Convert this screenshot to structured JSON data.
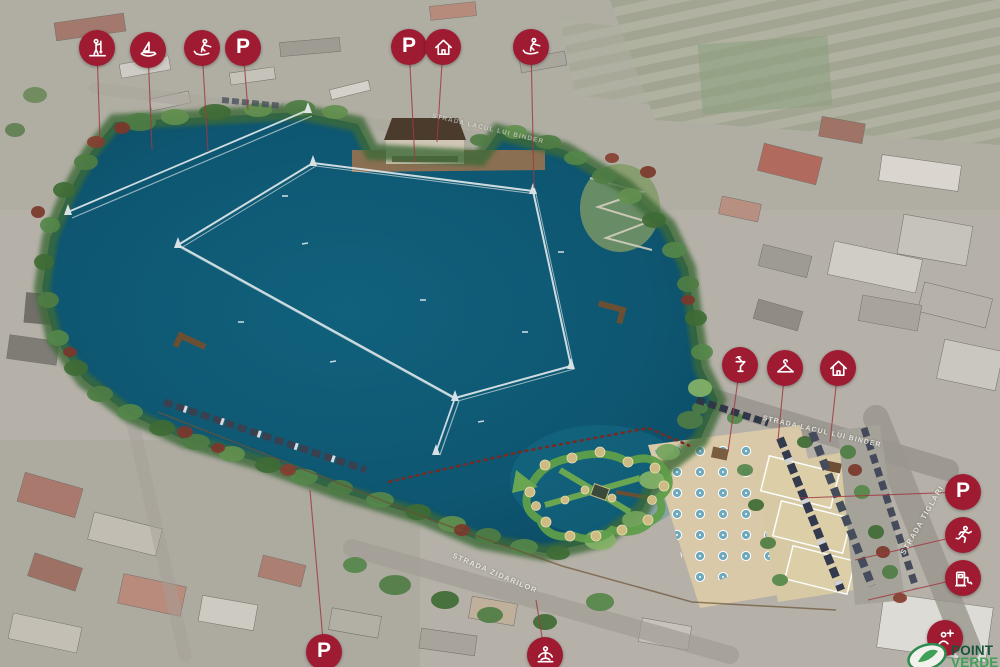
{
  "map": {
    "streets": [
      {
        "id": "binder-top",
        "name": "STRADA LACUL LUI BINDER"
      },
      {
        "id": "binder-mid",
        "name": "STRADA LACUL LUI BINDER"
      },
      {
        "id": "zidarilor",
        "name": "STRADA ZIDARILOR"
      },
      {
        "id": "tiglari",
        "name": "STRADA TIGLARI"
      }
    ],
    "logo": {
      "line1": "POINT",
      "line2": "VERDE"
    },
    "glyphs": {
      "parking": "P"
    },
    "colors": {
      "marker": "#9e1b32",
      "leader": "#a23a42",
      "lake": "#0e5a74",
      "logo_green_dark": "#17553a",
      "logo_green_light": "#3fa057"
    },
    "markers": [
      {
        "type": "sup",
        "x": 97,
        "y": 48,
        "tx": 100,
        "ty": 140
      },
      {
        "type": "sailing",
        "x": 148,
        "y": 50,
        "tx": 152,
        "ty": 150
      },
      {
        "type": "waterski",
        "x": 202,
        "y": 48,
        "tx": 208,
        "ty": 152
      },
      {
        "type": "parking",
        "x": 243,
        "y": 48,
        "tx": 248,
        "ty": 110
      },
      {
        "type": "parking",
        "x": 409,
        "y": 47,
        "tx": 415,
        "ty": 162
      },
      {
        "type": "house",
        "x": 443,
        "y": 47,
        "tx": 437,
        "ty": 142
      },
      {
        "type": "waterski",
        "x": 531,
        "y": 47,
        "tx": 534,
        "ty": 188
      },
      {
        "type": "cocktail",
        "x": 740,
        "y": 365,
        "tx": 728,
        "ty": 452
      },
      {
        "type": "hanger",
        "x": 785,
        "y": 368,
        "tx": 778,
        "ty": 440
      },
      {
        "type": "house",
        "x": 838,
        "y": 368,
        "tx": 830,
        "ty": 442
      },
      {
        "type": "parking",
        "x": 963,
        "y": 492,
        "tx": 800,
        "ty": 498
      },
      {
        "type": "runner",
        "x": 963,
        "y": 535,
        "tx": 855,
        "ty": 560
      },
      {
        "type": "charging",
        "x": 963,
        "y": 578,
        "tx": 868,
        "ty": 600
      },
      {
        "type": "parking",
        "x": 324,
        "y": 652,
        "tx": 310,
        "ty": 490
      },
      {
        "type": "yoga",
        "x": 545,
        "y": 655,
        "tx": 536,
        "ty": 600
      },
      {
        "type": "firstaid",
        "x": 945,
        "y": 638,
        "tx": 912,
        "ty": 658
      }
    ]
  }
}
